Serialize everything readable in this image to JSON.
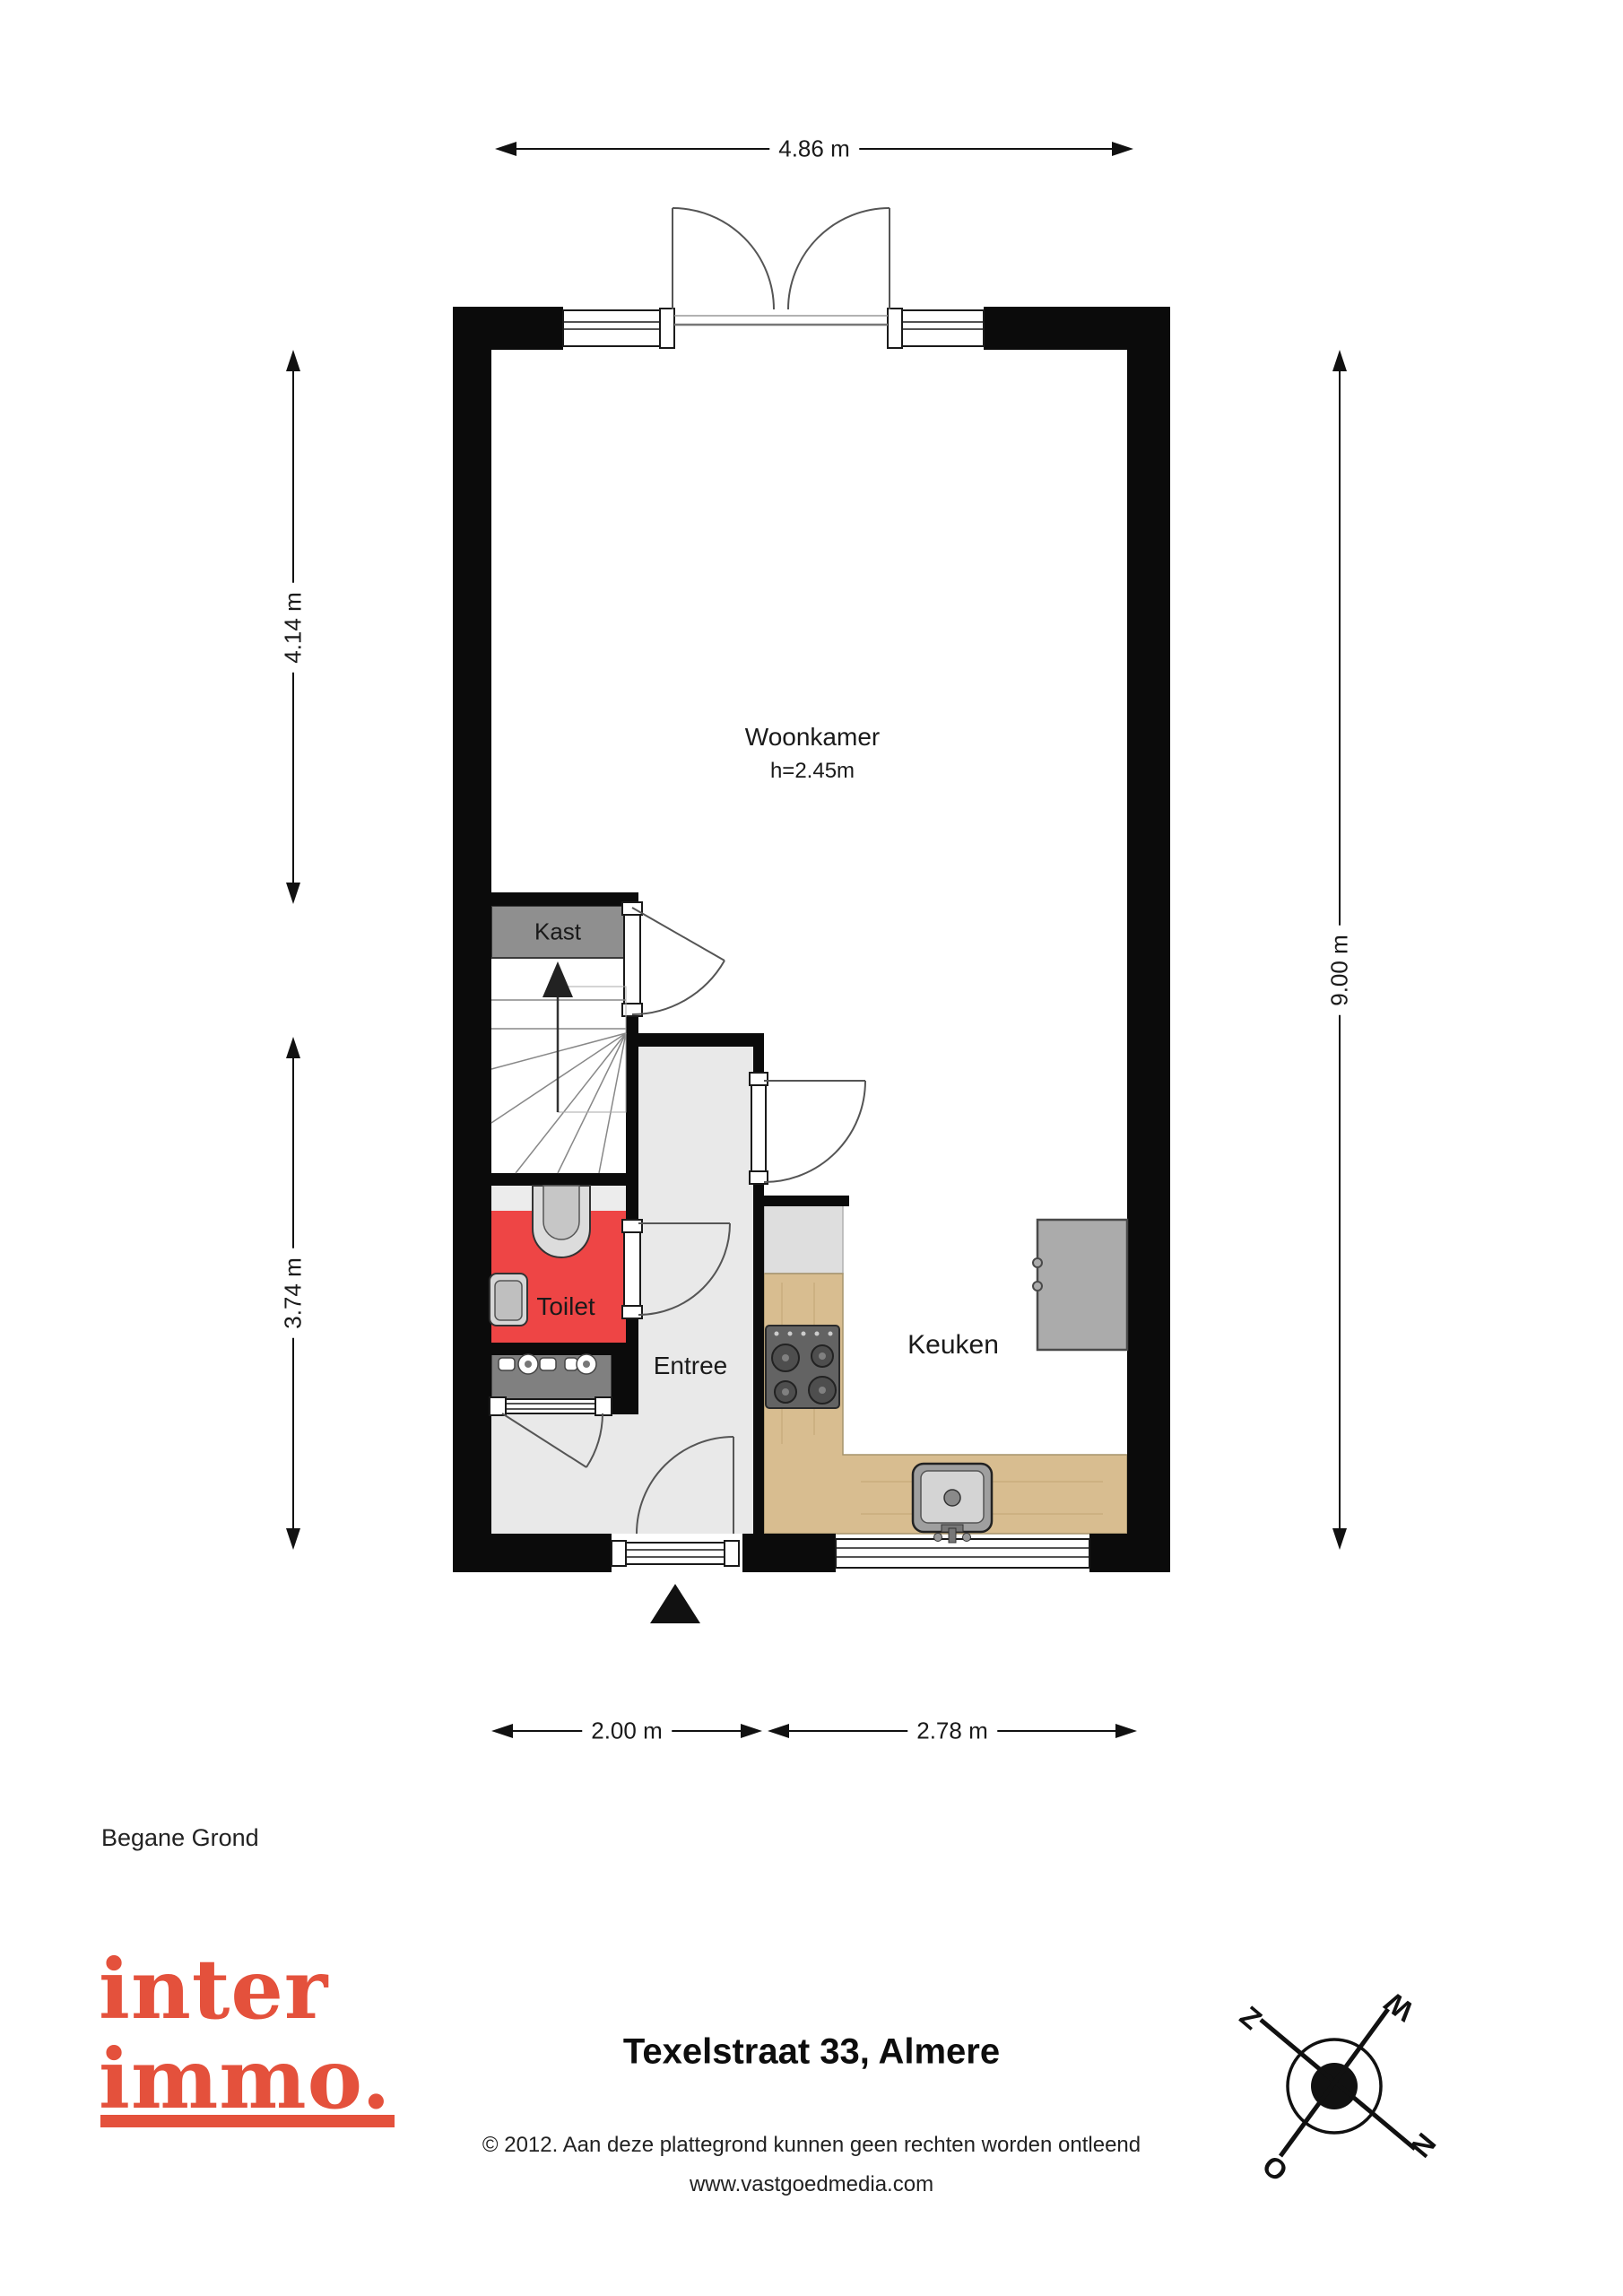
{
  "plan": {
    "floor_label": "Begane Grond",
    "rooms": {
      "woonkamer": {
        "label": "Woonkamer",
        "height_note": "h=2.45m"
      },
      "kast": {
        "label": "Kast"
      },
      "toilet": {
        "label": "Toilet"
      },
      "entree": {
        "label": "Entree"
      },
      "keuken": {
        "label": "Keuken"
      }
    },
    "dimensions": {
      "top_width": "4.86 m",
      "left_upper": "4.14 m",
      "left_lower": "3.74 m",
      "right_height": "9.00 m",
      "bottom_left": "2.00 m",
      "bottom_right": "2.78 m"
    },
    "colors": {
      "wall": "#0b0b0b",
      "toilet_floor": "#ee4545",
      "hall_floor": "#e9e9e9",
      "closet_fill": "#8f8f8f",
      "counter_wood": "#d8bd90",
      "counter_top_gray": "#dedede",
      "appliance_gray": "#ababab"
    }
  },
  "compass": {
    "north": "N",
    "east": "O",
    "south": "Z",
    "west": "W"
  },
  "footer": {
    "logo_line1": "inter",
    "logo_line2": "immo.",
    "logo_color": "#e4513c",
    "title": "Texelstraat 33, Almere",
    "copyright_line1": "© 2012. Aan deze plattegrond kunnen geen rechten worden ontleend",
    "copyright_line2": "www.vastgoedmedia.com"
  }
}
